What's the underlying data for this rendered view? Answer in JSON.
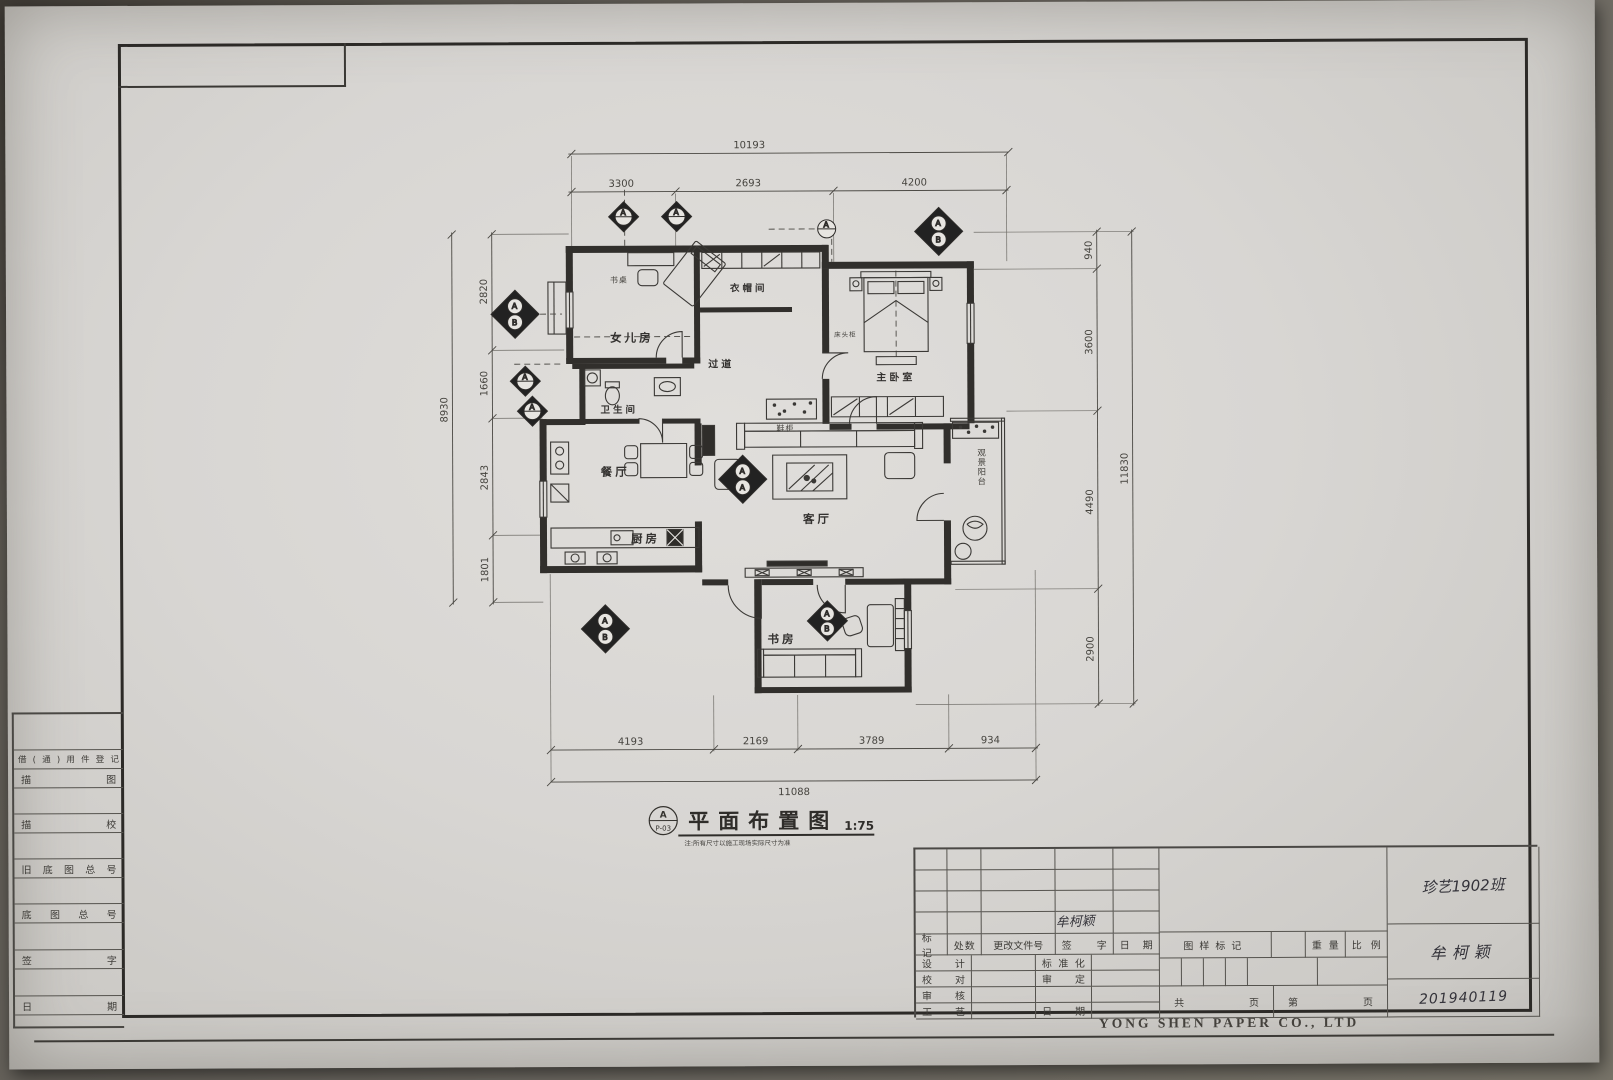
{
  "watermark": "YONG SHEN PAPER CO., LTD",
  "plan_title": {
    "text": "平面布置图",
    "scale": "1:75",
    "marker_letter": "A",
    "marker_ref": "P-03",
    "note": "注:所有尺寸以施工现场实际尺寸为准"
  },
  "markers": {
    "a": "A",
    "b": "B"
  },
  "rooms": {
    "daughter": "女儿房",
    "desk": "书桌",
    "cloak": "衣帽间",
    "master": "主卧室",
    "corridor": "过道",
    "bath": "卫生间",
    "dining": "餐厅",
    "kitchen": "厨房",
    "living": "客厅",
    "study": "书房",
    "shoe": "鞋柜",
    "balcony": "观景阳台",
    "bedside": "床头柜"
  },
  "dims": {
    "top": {
      "total": "10193",
      "segs": [
        "3300",
        "2693",
        "4200"
      ]
    },
    "left": {
      "total": "8930",
      "segs": [
        "2820",
        "1660",
        "2843",
        "1801"
      ]
    },
    "right": {
      "total": "11830",
      "segs": [
        "940",
        "3600",
        "4490",
        "2900"
      ]
    },
    "bottom": {
      "total": "11088",
      "segs": [
        "4193",
        "2169",
        "3789",
        "934"
      ]
    }
  },
  "sidebar": {
    "rows": [
      "借(通)用件登记",
      "描图",
      "描校",
      "旧底图总号",
      "底图总号",
      "签字",
      "日期"
    ]
  },
  "titleblock": {
    "header": [
      "标记",
      "处数",
      "更改文件号",
      "签字",
      "日期"
    ],
    "signature": "牟柯颖",
    "design": "设计",
    "standardization": "标准化",
    "proofread": "校对",
    "approve": "审定",
    "review": "审核",
    "process": "工艺",
    "date": "日期",
    "drawing_mark": "图样标记",
    "weight": "重量",
    "scale": "比例",
    "pages": [
      "共",
      "页",
      "第",
      "页"
    ],
    "handwritten": {
      "class": "珍艺1902班",
      "name": "牟柯颖",
      "student_id": "201940119"
    }
  }
}
